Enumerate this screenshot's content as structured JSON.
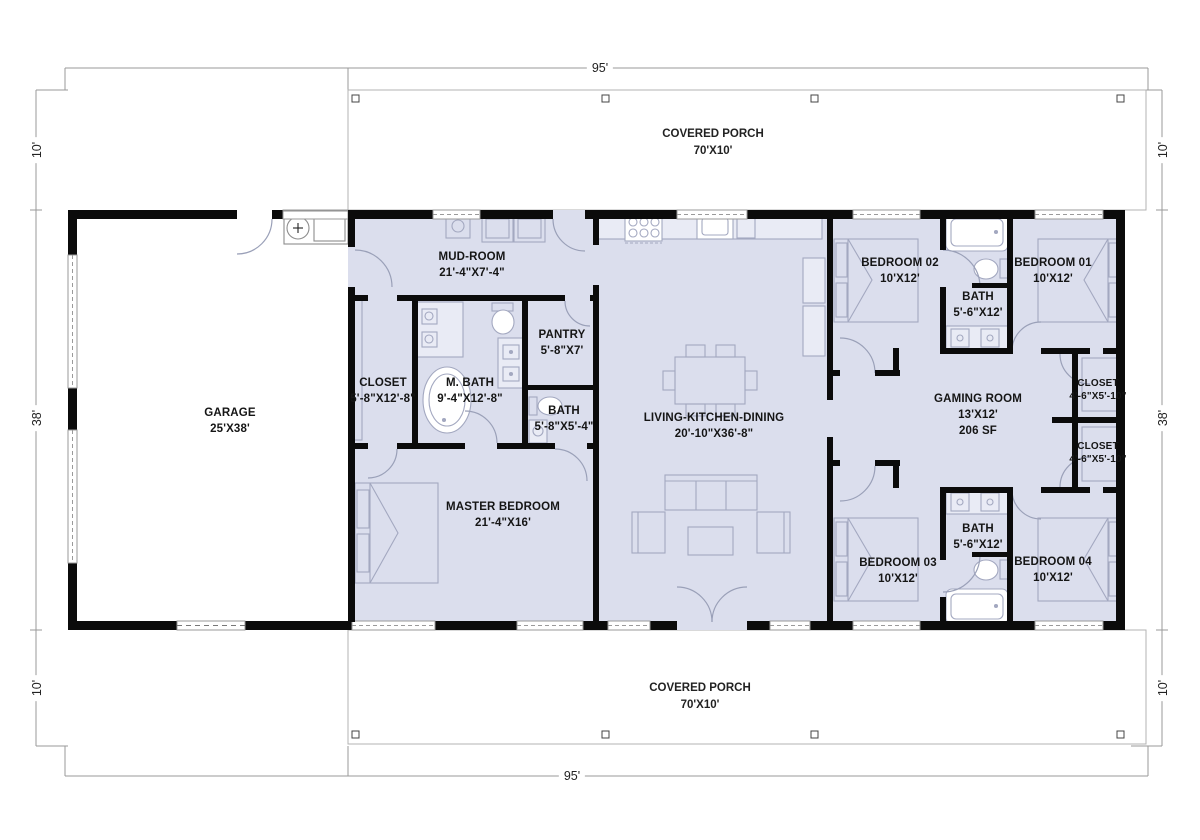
{
  "plan": {
    "title": "barndominium-style single story floor plan",
    "dimensions": {
      "top": "95'",
      "bottom": "95'",
      "left_top": "10'",
      "left_mid": "38'",
      "left_bottom": "10'",
      "right_top": "10'",
      "right_mid": "38'",
      "right_bottom": "10'"
    },
    "porches": {
      "top": {
        "name": "COVERED PORCH",
        "dims": "70'X10'"
      },
      "bottom": {
        "name": "COVERED PORCH",
        "dims": "70'X10'"
      }
    },
    "rooms": [
      {
        "name": "GARAGE",
        "dims": "25'X38'"
      },
      {
        "name": "MUD-ROOM",
        "dims": "21'-4\"X7'-4\""
      },
      {
        "name": "CLOSET",
        "dims": "5'-8\"X12'-8\""
      },
      {
        "name": "M. BATH",
        "dims": "9'-4\"X12'-8\""
      },
      {
        "name": "PANTRY",
        "dims": "5'-8\"X7'"
      },
      {
        "name": "BATH",
        "dims": "5'-8\"X5'-4\""
      },
      {
        "name": "LIVING-KITCHEN-DINING",
        "dims": "20'-10\"X36'-8\""
      },
      {
        "name": "MASTER BEDROOM",
        "dims": "21'-4\"X16'"
      },
      {
        "name": "BEDROOM 02",
        "dims": "10'X12'"
      },
      {
        "name": "BATH",
        "dims": "5'-6\"X12'"
      },
      {
        "name": "BEDROOM 01",
        "dims": "10'X12'"
      },
      {
        "name": "GAMING ROOM",
        "dims": "13'X12'",
        "area": "206 SF"
      },
      {
        "name": "CLOSET",
        "dims": "4'-6\"X5'-10\""
      },
      {
        "name": "CLOSET",
        "dims": "4'-6\"X5'-10\""
      },
      {
        "name": "BEDROOM 03",
        "dims": "10'X12'"
      },
      {
        "name": "BATH",
        "dims": "5'-6\"X12'"
      },
      {
        "name": "BEDROOM 04",
        "dims": "10'X12'"
      }
    ],
    "colors": {
      "wall": "#0b0b0b",
      "interior_fill": "#dbdeed",
      "furniture_line": "#a3a8c0",
      "dimension_line": "#9a9a9a"
    }
  }
}
